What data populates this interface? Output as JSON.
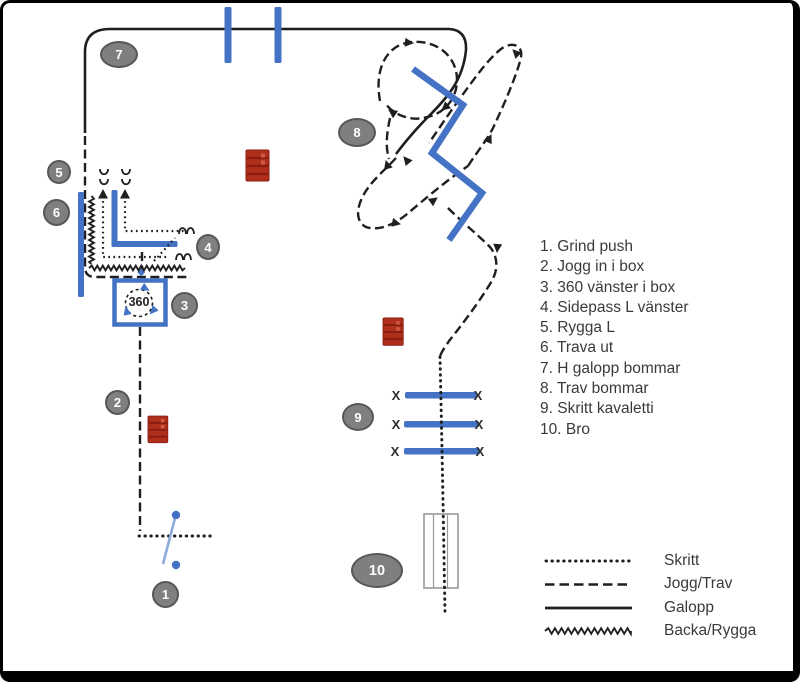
{
  "diagram": {
    "stations": [
      {
        "number": "1",
        "name": "Grind push",
        "list_text": "1. Grind push"
      },
      {
        "number": "2",
        "name": "Jogg in i box",
        "list_text": "2. Jogg in i box"
      },
      {
        "number": "3",
        "name": "360 vänster i box",
        "list_text": "3. 360 vänster i box"
      },
      {
        "number": "4",
        "name": "Sidepass L vänster",
        "list_text": "4. Sidepass L vänster"
      },
      {
        "number": "5",
        "name": "Rygga L",
        "list_text": "5. Rygga L"
      },
      {
        "number": "6",
        "name": "Trava ut",
        "list_text": "6. Trava ut"
      },
      {
        "number": "7",
        "name": "H galopp bommar",
        "list_text": "7. H galopp bommar"
      },
      {
        "number": "8",
        "name": "Trav bommar",
        "list_text": "8. Trav bommar"
      },
      {
        "number": "9",
        "name": "Skritt kavaletti",
        "list_text": "9. Skritt kavaletti"
      },
      {
        "number": "10",
        "name": "Bro",
        "list_text": "10. Bro"
      }
    ],
    "box_rotation_label": "360",
    "kavaletti_end_marker": "X",
    "legend": [
      {
        "style": "dotted",
        "label": "Skritt"
      },
      {
        "style": "dashed",
        "label": "Jogg/Trav"
      },
      {
        "style": "solid",
        "label": "Galopp"
      },
      {
        "style": "zigzag",
        "label": "Backa/Rygga"
      }
    ],
    "colors": {
      "pole_blue": "#4472C4",
      "gate_blue": "#8FAADC",
      "barrel_red": "#B02E1C",
      "badge_fill": "#7F7F7F",
      "badge_border": "#575757",
      "line_black": "#1F1F1F",
      "text": "#3A3A3A"
    }
  }
}
